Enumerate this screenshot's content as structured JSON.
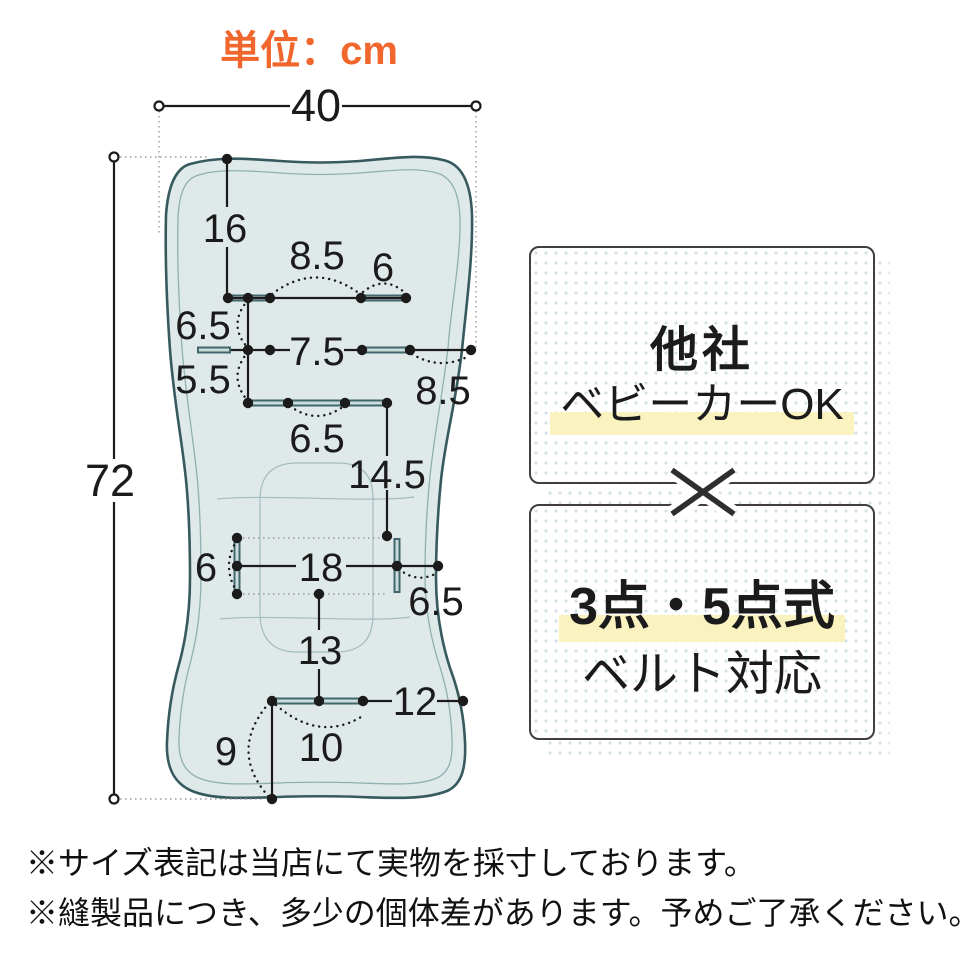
{
  "header": {
    "unit_label": "単位：cm",
    "unit_color": "#f1662d"
  },
  "diagram": {
    "dims": {
      "width_top": "40",
      "height_total": "72",
      "top_edge_to_row1": "16",
      "row1_slot_gap": "8.5",
      "row1_right_slot": "6",
      "row1_to_row2": "6.5",
      "row2_slot_gap": "7.5",
      "row2_to_row3": "5.5",
      "row2_to_edge": "8.5",
      "row3_slot_gap": "6.5",
      "row3_to_seat": "14.5",
      "seat_slot_height": "6",
      "seat_slot_gap": "18",
      "seat_to_edge": "6.5",
      "seat_to_bottom_slot": "13",
      "bottom_slot_to_edge": "12",
      "bottom_slot_width": "10",
      "bottom_slot_to_bottom": "9"
    },
    "colors": {
      "pad_fill": "#e0e9e9",
      "pad_outline": "#365a5e",
      "stitch_line": "#8fb0b2",
      "slot": "#41666b",
      "dimension": "#1b1b1b"
    }
  },
  "panel": {
    "box_top": {
      "title": "他社",
      "subtitle": "ベビーカーOK"
    },
    "box_bottom": {
      "title": "3点・5点式",
      "subtitle": "ベルト対応"
    },
    "cross_icon": "×",
    "highlight_color": "#faf3c0",
    "dot_color": "#d3e2ea"
  },
  "footnotes": [
    "※サイズ表記は当店にて実物を採寸しております。",
    "※縫製品につき、多少の個体差があります。予めご了承ください。"
  ]
}
